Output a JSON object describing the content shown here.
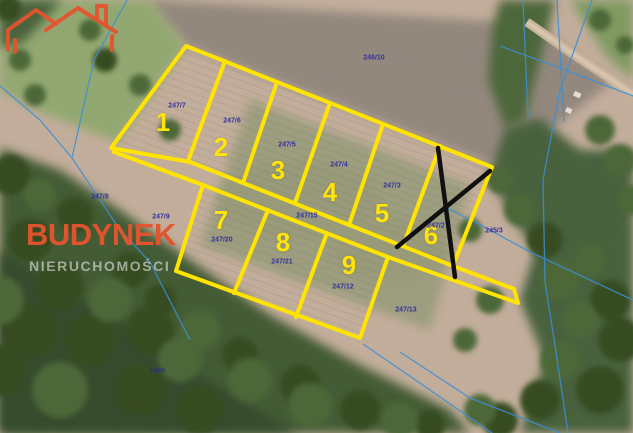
{
  "watermark": {
    "brand": "BUDYNEK",
    "tagline": "NIERUCHOMOŚCI",
    "brand_color": "#e4542e"
  },
  "map": {
    "colors": {
      "plot_outline": "#ffe400",
      "parcel_label": "#2a2a9e",
      "sold_cross": "#101010",
      "cadastral_line": "#3c8fd6"
    },
    "plots": [
      {
        "number": "1",
        "parcel": "247/7",
        "sold": false,
        "num_pos": [
          163,
          122
        ],
        "parcel_pos": [
          177,
          106
        ]
      },
      {
        "number": "2",
        "parcel": "247/6",
        "sold": false,
        "num_pos": [
          221,
          147
        ],
        "parcel_pos": [
          232,
          121
        ]
      },
      {
        "number": "3",
        "parcel": "247/5",
        "sold": false,
        "num_pos": [
          278,
          170
        ],
        "parcel_pos": [
          287,
          145
        ]
      },
      {
        "number": "4",
        "parcel": "247/4",
        "sold": false,
        "num_pos": [
          330,
          192
        ],
        "parcel_pos": [
          339,
          165
        ]
      },
      {
        "number": "5",
        "parcel": "247/3",
        "sold": false,
        "num_pos": [
          382,
          213
        ],
        "parcel_pos": [
          392,
          186
        ]
      },
      {
        "number": "6",
        "parcel": "247/2",
        "sold": true,
        "num_pos": [
          431,
          235
        ],
        "parcel_pos": [
          436,
          226
        ]
      },
      {
        "number": "7",
        "parcel": "247/20",
        "sold": false,
        "num_pos": [
          221,
          220
        ],
        "parcel_pos": [
          222,
          240
        ]
      },
      {
        "number": "8",
        "parcel": "247/21",
        "sold": false,
        "num_pos": [
          283,
          242
        ],
        "parcel_pos": [
          282,
          262
        ]
      },
      {
        "number": "9",
        "parcel": "247/12",
        "sold": false,
        "num_pos": [
          349,
          265
        ],
        "parcel_pos": [
          343,
          287
        ]
      }
    ],
    "other_parcels": [
      {
        "text": "246/10",
        "pos": [
          374,
          58
        ]
      },
      {
        "text": "247/8",
        "pos": [
          100,
          197
        ]
      },
      {
        "text": "247/9",
        "pos": [
          161,
          217
        ]
      },
      {
        "text": "247/15",
        "pos": [
          307,
          216
        ]
      },
      {
        "text": "247/13",
        "pos": [
          406,
          310
        ]
      },
      {
        "text": "245/3",
        "pos": [
          494,
          231
        ]
      },
      {
        "text": "1480",
        "pos": [
          157,
          371
        ]
      }
    ]
  }
}
